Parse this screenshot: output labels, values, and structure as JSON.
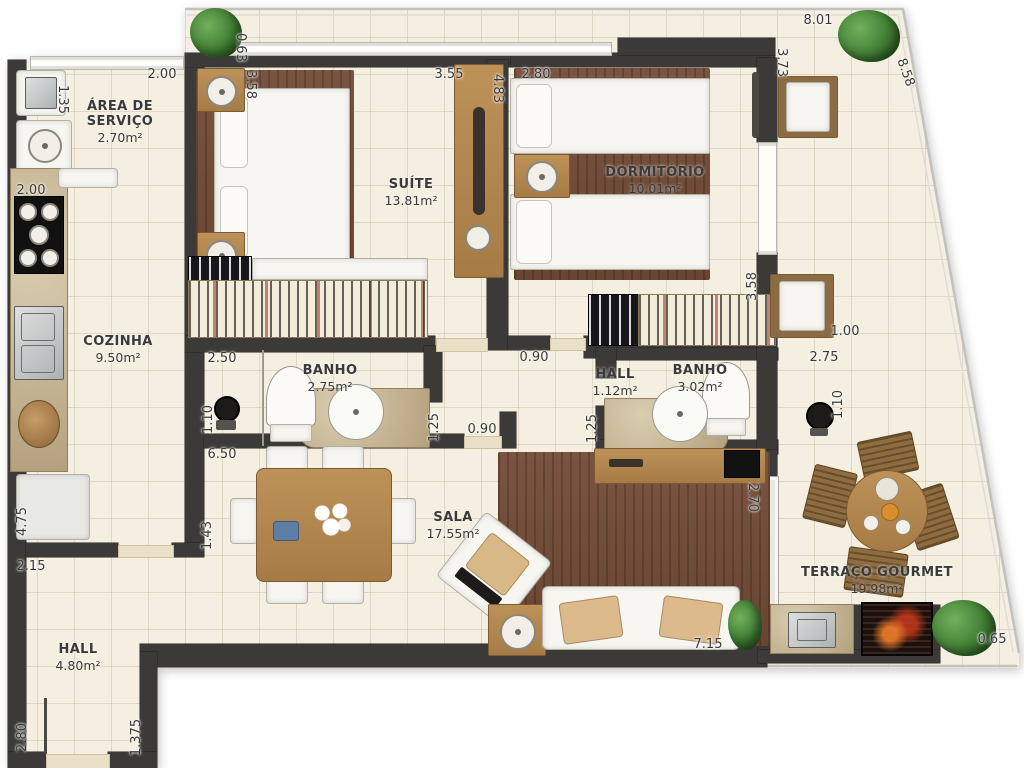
{
  "rooms": {
    "r1": {
      "name": "ÁREA DE SERVIÇO",
      "area": "2.70m²"
    },
    "r2": {
      "name": "COZINHA",
      "area": "9.50m²"
    },
    "r3": {
      "name": "SUÍTE",
      "area": "13.81m²"
    },
    "r4": {
      "name": "DORMITÓRIO",
      "area": "10.01m²"
    },
    "r5": {
      "name": "BANHO",
      "area": "2.75m²"
    },
    "r6": {
      "name": "HALL",
      "area": "1.12m²"
    },
    "r7": {
      "name": "BANHO",
      "area": "3.02m²"
    },
    "r8": {
      "name": "SALA",
      "area": "17.55m²"
    },
    "r9": {
      "name": "TERRAÇO GOURMET",
      "area": "19.98m²"
    },
    "r10": {
      "name": "HALL",
      "area": "4.80m²"
    }
  },
  "dims": {
    "d1": "8.01",
    "d2": "8.58",
    "d3": "0.63",
    "d4": "2.00",
    "d5": "1.35",
    "d6": "2.00",
    "d7": "3.58",
    "d8": "3.55",
    "d9": "4.83",
    "d10": "2.80",
    "d11": "3.73",
    "d12": "2.50",
    "d13": "1.10",
    "d14": "1.25",
    "d15": "0.90",
    "d16": "0.90",
    "d17": "1.25",
    "d18": "2.75",
    "d19": "1.10",
    "d20": "1.00",
    "d21": "3.58",
    "d22": "6.50",
    "d23": "1.43",
    "d24": "2.70",
    "d25": "7.15",
    "d26": "0.65",
    "d27": "2.15",
    "d28": "4.75",
    "d29": "2.80",
    "d30": "1.375"
  },
  "colors": {
    "wall": "#3b3a38",
    "floor": "#f4efe1",
    "wood_furniture": "#b18553",
    "bedroom_rug": "#7b5440",
    "marble": "#c9b995",
    "plant_green": "#3f7d33"
  }
}
